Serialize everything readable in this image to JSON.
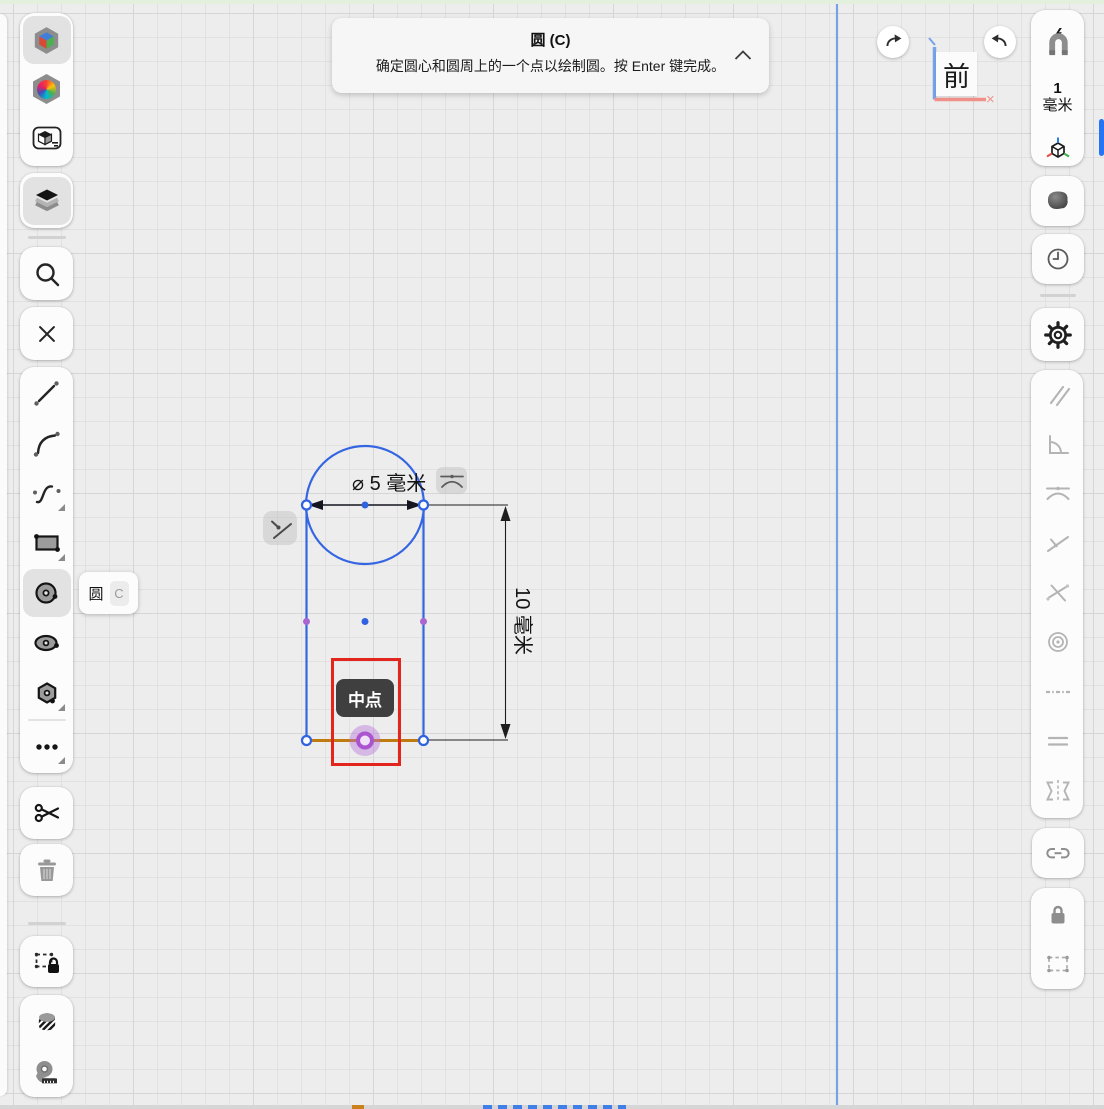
{
  "banner": {
    "title": "圆 (C)",
    "description": "确定圆心和圆周上的一个点以绘制圆。按 Enter 键完成。"
  },
  "tool_tooltip": {
    "label": "圆",
    "shortcut": "C"
  },
  "snap_tooltip": {
    "label": "中点"
  },
  "view_indicator": {
    "label": "前",
    "axis_cross": "×"
  },
  "grid_size": {
    "value": "1",
    "unit": "毫米"
  },
  "dimensions": {
    "diameter_label": "⌀ 5 毫米",
    "length_label": "10 毫米"
  },
  "colors": {
    "sketch_blue": "#3566e2",
    "highlight_orange": "#bf7a10",
    "midpoint_purple": "#a966d1",
    "warning_red": "#e3261d",
    "axis_blue": "#76a3e8",
    "axis_red": "#f09089"
  },
  "left_toolbar": {
    "items": [
      "orientation-cube",
      "appearance",
      "isometric-view",
      "layers",
      "search",
      "close",
      "line-tool",
      "arc-tool",
      "spline-tool",
      "rectangle-tool",
      "circle-tool",
      "ellipse-tool",
      "polygon-tool",
      "more-tools",
      "trim",
      "delete",
      "lock-selection",
      "hatch",
      "measure"
    ]
  },
  "right_toolbar": {
    "items": [
      "snap",
      "grid-size",
      "axis-orientation",
      "shading",
      "history",
      "settings",
      "parallel",
      "perpendicular",
      "tangent",
      "point-on-line",
      "intersection",
      "concentric",
      "construction",
      "equal",
      "symmetric",
      "link",
      "lock",
      "selection-box"
    ]
  }
}
